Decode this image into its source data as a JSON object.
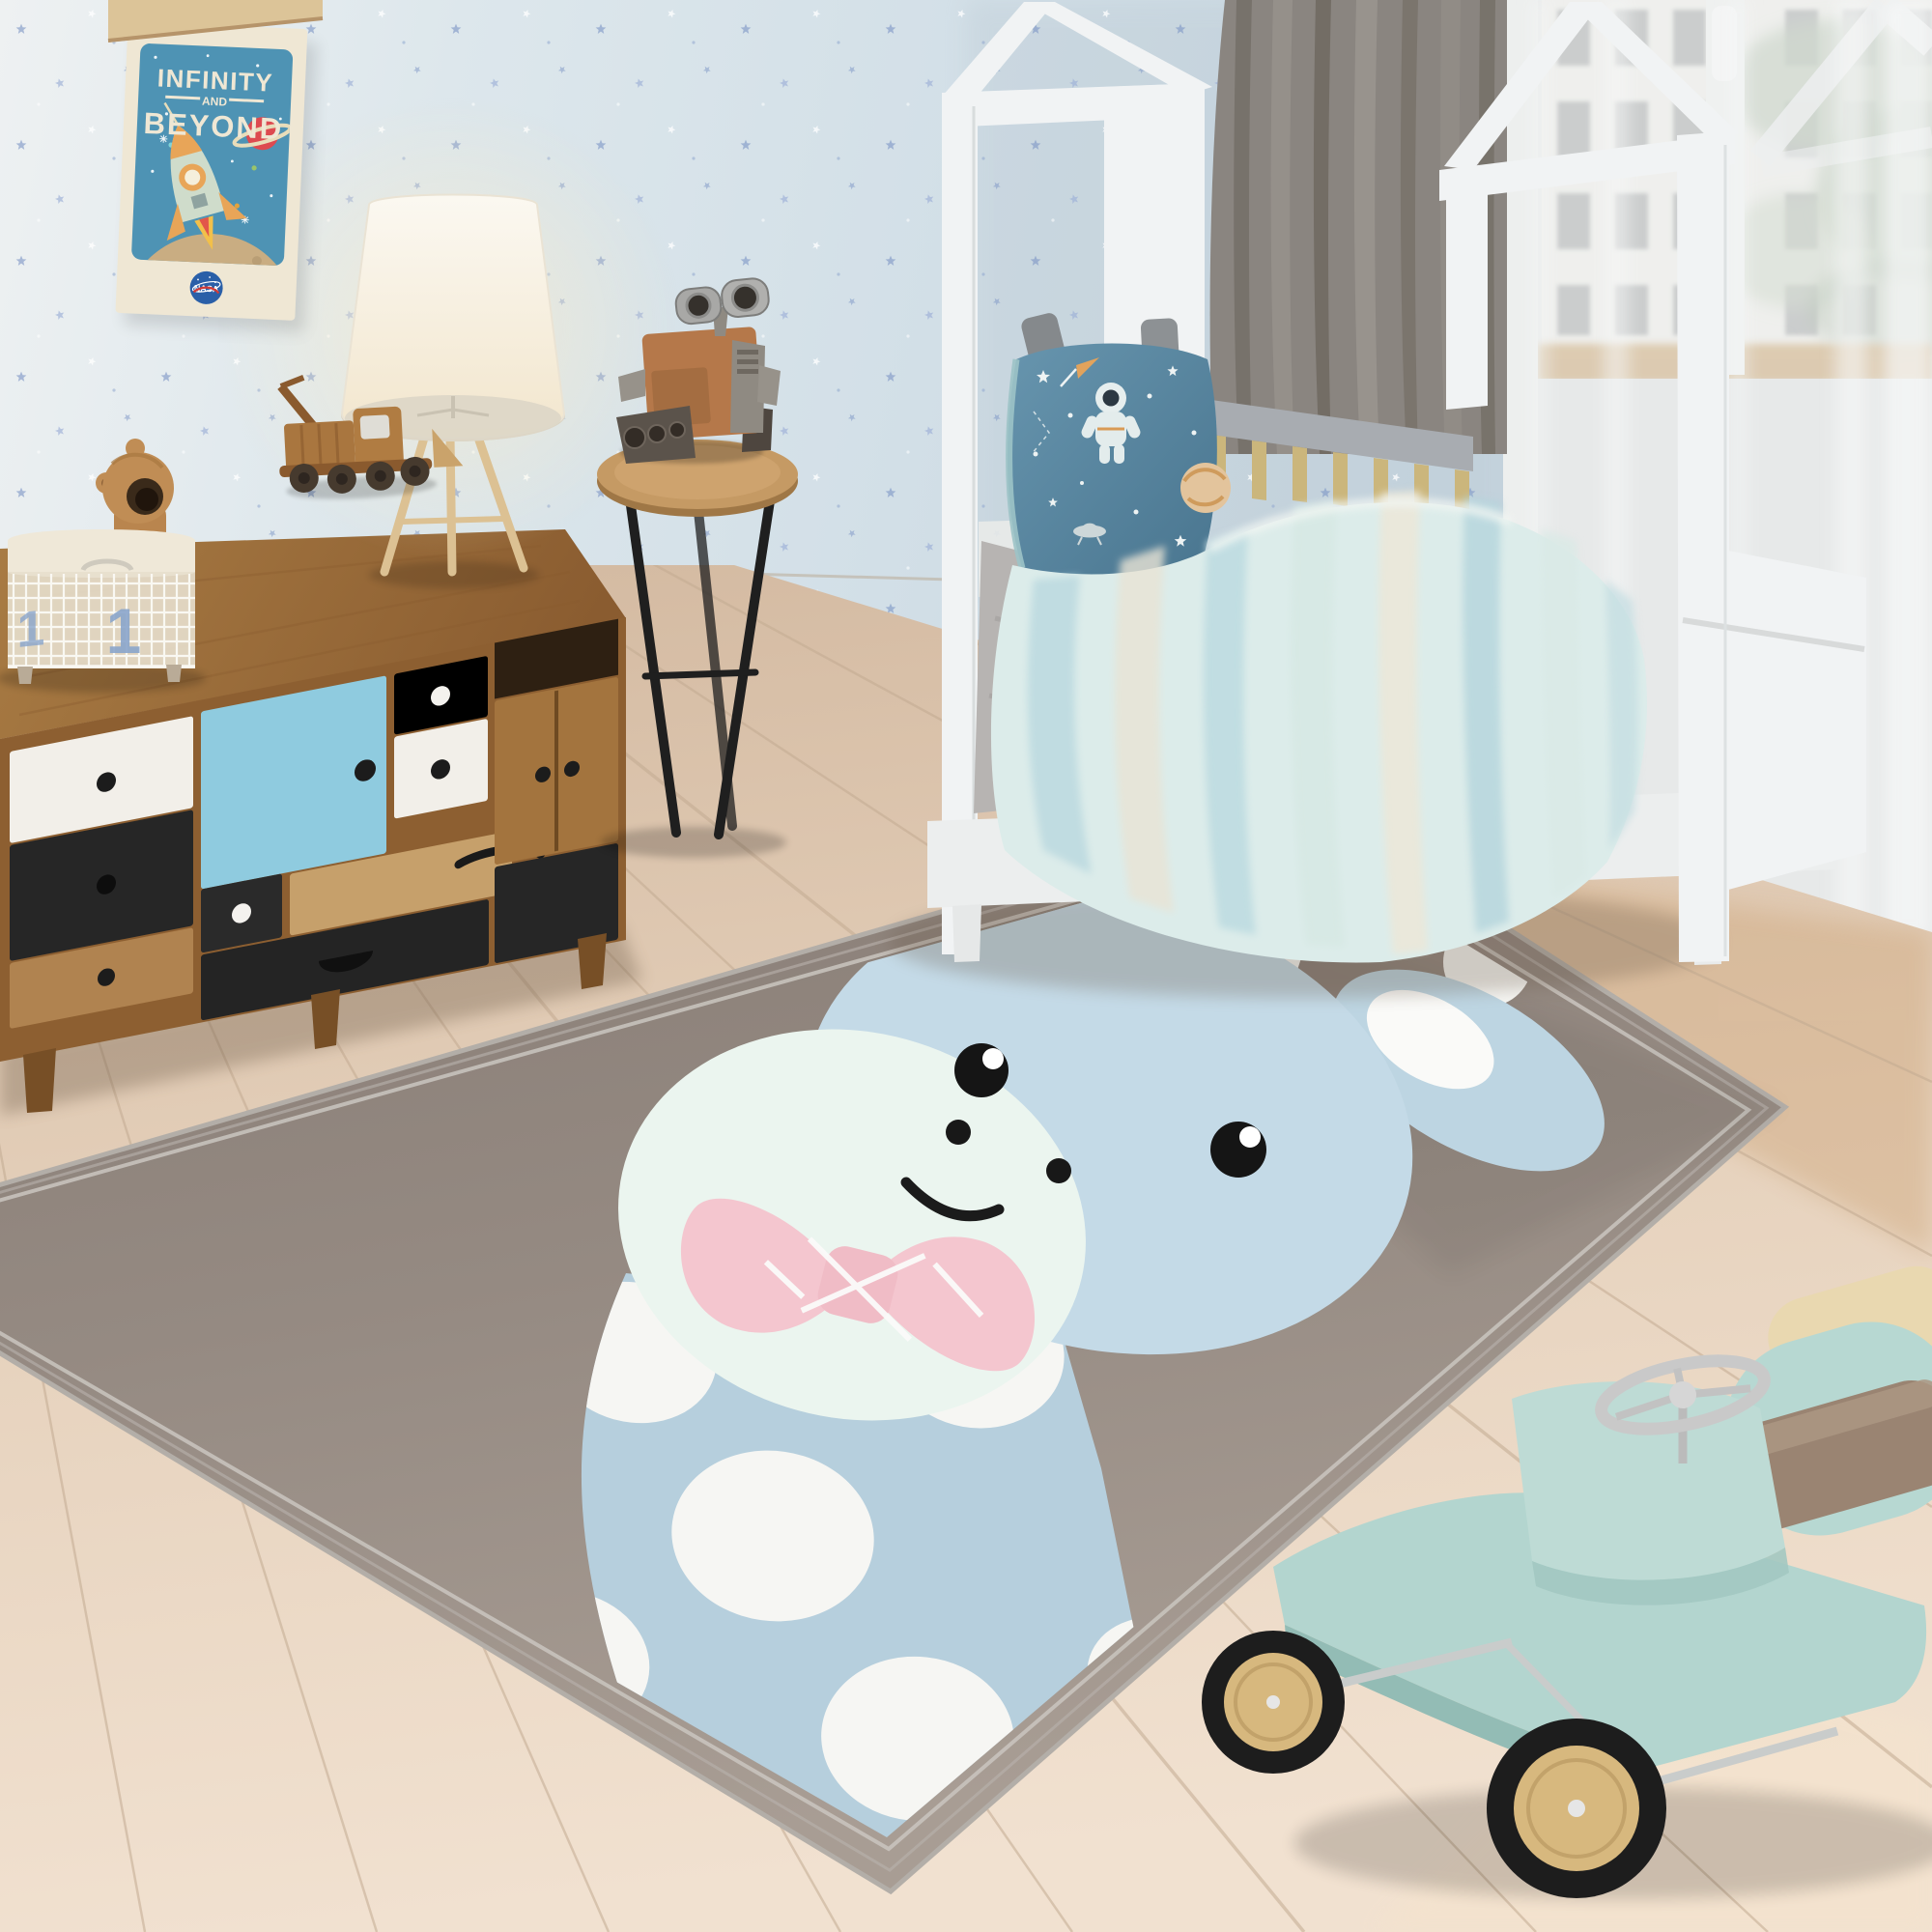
{
  "scene": {
    "type": "photograph",
    "subject": "children's bedroom with grey giraffe kids rug, house-frame bed, vintage dresser and toys"
  },
  "poster": {
    "title_line1": "INFINITY",
    "title_line2": "AND",
    "title_line3": "BEYOND",
    "logo_text": "NASA"
  },
  "basket": {
    "count_front": "1",
    "count_side": "1"
  },
  "palette": {
    "wall": "#d5e1e8",
    "wall_light": "#ecf1f2",
    "floor": "#e2ccb5",
    "floor_light": "#f0e0cf",
    "rug": "#8f847c",
    "rug_light": "#a89d94",
    "rug_border": "#cac5c0",
    "giraffe_body": "#c4dae7",
    "giraffe_muzzle": "#ebf5ef",
    "giraffe_spot": "#f6f6f3",
    "bow_pink": "#f4c6cf",
    "line_black": "#1b1b1b",
    "dresser_wood": "#9a6b38",
    "drawer_blue": "#8fcbdf",
    "drawer_white": "#f2efe9",
    "drawer_black": "#262626",
    "bed_frame": "#f1f3f4",
    "curtain_gray": "#8a8580",
    "sheer_white": "#eceeee",
    "blanket_aqua": "#dcecea",
    "pillow_teal": "#55819f",
    "sheet_gray": "#b7b4b2",
    "car_mint": "#b3d5cf",
    "wheel_wood": "#d7b87e",
    "tire_black": "#1d1d1d",
    "basket_liner": "#efe8d8",
    "basket_number_blue": "#8aa6cc",
    "poster_blue": "#4e93b4",
    "poster_cream": "#efe7d4",
    "nasa_blue": "#2a5fa8",
    "lamp_shade": "#f8f4ea",
    "table_wood": "#c59a64",
    "toy_rust": "#b5784a"
  }
}
